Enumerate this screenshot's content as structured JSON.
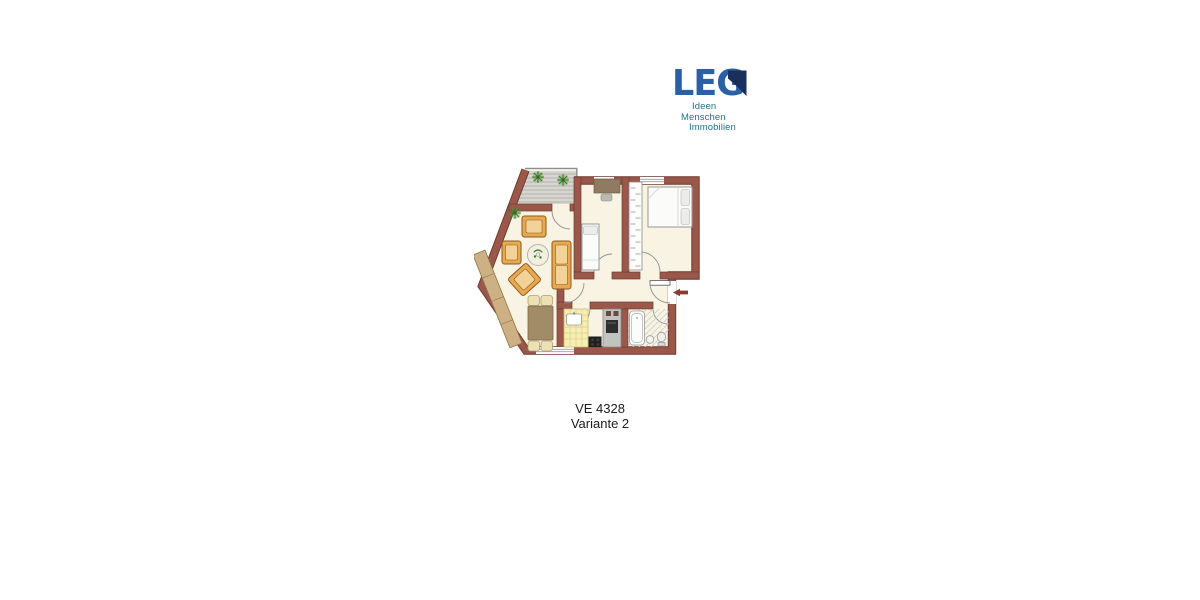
{
  "logo": {
    "brand": "LEG",
    "tagline": [
      "Ideen",
      "Menschen",
      "Immobilien"
    ]
  },
  "caption": {
    "unit": "VE 4328",
    "variant": "Variante 2"
  },
  "colors": {
    "page_bg": "#ffffff",
    "wall": "#9a574a",
    "wall_edge": "#6e3c31",
    "floor": "#f8f3e3",
    "deck": "#d6d5d0",
    "deck_line": "#b5b4ae",
    "railing": "#8f8f8f",
    "wood": "#e8a94e",
    "wood_dark": "#8a5a23",
    "cushion": "#f3d297",
    "sideboard": "#cdb184",
    "sideboard_edge": "#8f7347",
    "dining_table": "#a28c67",
    "chair": "#ece0b4",
    "chair_edge": "#b3a070",
    "bed": "#fbfbfa",
    "bed_edge": "#999996",
    "pillow": "#ececea",
    "cabinet": "#8f7a62",
    "counter": "#f7eeb2",
    "counter_edge": "#c8b972",
    "tile_line": "#dbcf92",
    "appliance": "#c2c2c0",
    "stove": "#1f1f1f",
    "hatch": "#cfcfca",
    "plant": "#3c7a28",
    "arrow": "#8e3a2e",
    "logo_blue": "#2a60a6",
    "logo_navy": "#1b2f5c",
    "logo_teal": "#1c7492",
    "text": "#1c1c1c"
  }
}
